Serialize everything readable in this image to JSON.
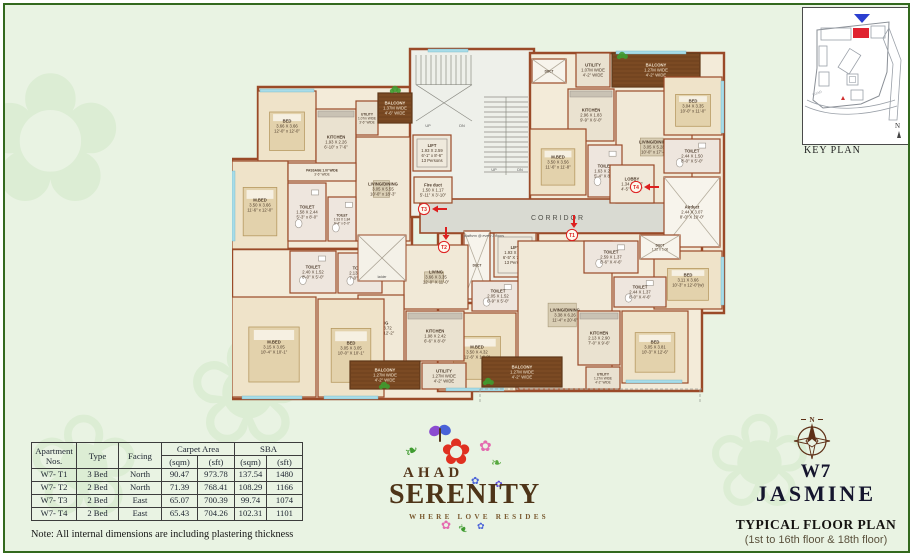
{
  "keyplan": {
    "label": "KEY PLAN",
    "road_label": "ROAD",
    "north_label": "N",
    "highlight_color": "#e02330",
    "marker_color": "#2b3fd0"
  },
  "logo": {
    "ahad": "AHAD",
    "serenity": "SERENITY",
    "tagline": "WHERE LOVE RESIDES"
  },
  "titles": {
    "tower": "W7",
    "name": "JASMINE",
    "plan_title": "TYPICAL FLOOR PLAN",
    "plan_subtitle": "(1st to 16th floor & 18th floor)",
    "compass_n": "N"
  },
  "note": "Note: All internal dimensions are including plastering thickness",
  "table": {
    "headers": {
      "apartment": "Apartment Nos.",
      "type": "Type",
      "facing": "Facing",
      "carpet": "Carpet Area",
      "sba": "SBA",
      "sqm": "(sqm)",
      "sft": "(sft)"
    },
    "rows": [
      [
        "W7- T1",
        "3 Bed",
        "North",
        "90.47",
        "973.78",
        "137.54",
        "1480"
      ],
      [
        "W7- T2",
        "2 Bed",
        "North",
        "71.39",
        "768.41",
        "108.29",
        "1166"
      ],
      [
        "W7- T3",
        "2 Bed",
        "East",
        "65.07",
        "700.39",
        "99.74",
        "1074"
      ],
      [
        "W7- T4",
        "2 Bed",
        "East",
        "65.43",
        "704.26",
        "102.31",
        "1101"
      ]
    ]
  },
  "plan": {
    "wall_color": "#9a4a28",
    "unit_fill": "#f3ebd9",
    "core_fill": "#eef0ea",
    "corridor_fill": "#d9dad2",
    "balcony_fill": "#7b4a23",
    "accent_red": "#dd1f1f",
    "window_color": "#a8dce8",
    "label_color": "#4c3a2a",
    "blocks": [
      {
        "n": "unit-t3",
        "p": "M26,42 L180,42 L180,204 L0,204 L0,114 L26,114 Z",
        "f": "unit"
      },
      {
        "n": "core-north",
        "p": "M178,4 L302,4 L302,172 L178,172 Z",
        "f": "core"
      },
      {
        "n": "unit-t4",
        "p": "M298,8 L492,8 L492,268 L418,268 L418,192 L298,192 Z",
        "f": "unit"
      },
      {
        "n": "unit-t2",
        "p": "M0,204 L240,204 L240,354 L0,354 Z",
        "f": "unit"
      },
      {
        "n": "unit-t1",
        "p": "M206,188 L470,188 L470,346 L206,346 Z",
        "f": "unit"
      },
      {
        "n": "core-south",
        "p": "M230,184 L306,184 L306,258 L230,258 Z",
        "f": "core"
      }
    ],
    "corridor": {
      "x": 188,
      "y": 154,
      "w": 248,
      "h": 34,
      "label": "CORRIDOR"
    },
    "rooms": [
      {
        "n": "bed-t3",
        "t": "bed",
        "x": 26,
        "y": 46,
        "w": 58,
        "h": 70,
        "l": [
          "BED",
          "3.66 X 3.66",
          "12'-0\" x 12'-0\""
        ]
      },
      {
        "n": "mbed-t3",
        "t": "bed",
        "x": 0,
        "y": 116,
        "w": 56,
        "h": 88,
        "l": [
          "M.BED",
          "3.50 X 3.66",
          "11'-6\" x 12'-0\""
        ]
      },
      {
        "n": "kitchen-t3",
        "t": "kitchen",
        "x": 84,
        "y": 64,
        "w": 40,
        "h": 66,
        "l": [
          "KITCHEN",
          "1.93 X 2.26",
          "6'-10\" x 7'-6\""
        ]
      },
      {
        "n": "utility-t3",
        "t": "utility",
        "x": 124,
        "y": 56,
        "w": 22,
        "h": 34,
        "l": [
          "UTILITY",
          "1.07m WIDE",
          "3'-6\" WIDE"
        ]
      },
      {
        "n": "balcony-t3",
        "t": "balcony",
        "x": 146,
        "y": 48,
        "w": 34,
        "h": 30,
        "l": [
          "BALCONY",
          "1.37M WIDE",
          "4'-6\" WIDE"
        ]
      },
      {
        "n": "living-dining-t3",
        "t": "living",
        "x": 124,
        "y": 92,
        "w": 54,
        "h": 104,
        "l": [
          "LIVING/DINING",
          "3.05 X 5.55",
          "10'-0\" x 18'-3\""
        ]
      },
      {
        "n": "passage-t3",
        "t": "lobby",
        "x": 56,
        "y": 118,
        "w": 68,
        "h": 18,
        "l": [
          "PASSAGE 1.07 WIDE",
          "3'-6\" WIDE"
        ]
      },
      {
        "n": "toilet-t3-a",
        "t": "toilet",
        "x": 56,
        "y": 138,
        "w": 38,
        "h": 58,
        "l": [
          "TOILET",
          "1.58 X 2.44",
          "5'-3\" x 8'-0\""
        ]
      },
      {
        "n": "toilet-t3-b",
        "t": "toilet",
        "x": 96,
        "y": 152,
        "w": 28,
        "h": 44,
        "l": [
          "TOILET",
          "1.93 X 1.84",
          "6'-4\" x 6'-0\""
        ]
      },
      {
        "n": "lift-1",
        "t": "lift",
        "x": 181,
        "y": 90,
        "w": 38,
        "h": 36,
        "l": [
          "LIFT",
          "1.93 X 2.59",
          "6'-1\" x 8'-6\"",
          "13 Persons"
        ]
      },
      {
        "n": "fire-duct",
        "t": "lobby",
        "x": 182,
        "y": 132,
        "w": 38,
        "h": 26,
        "l": [
          "Fire duct",
          "1.50 X 1.17",
          "5'-11\" X 3'-10\""
        ]
      },
      {
        "n": "duct-t4-top",
        "t": "duct",
        "x": 300,
        "y": 14,
        "w": 34,
        "h": 24,
        "l": [
          "DUCT"
        ]
      },
      {
        "n": "utility-t4",
        "t": "utility",
        "x": 344,
        "y": 8,
        "w": 34,
        "h": 34,
        "l": [
          "UTILITY",
          "1.07M WIDE",
          "4'-2\" WIDE"
        ]
      },
      {
        "n": "balcony-t4",
        "t": "balcony",
        "x": 380,
        "y": 8,
        "w": 88,
        "h": 34,
        "l": [
          "BALCONY",
          "1.27M WIDE",
          "4'-2\" WIDE"
        ]
      },
      {
        "n": "kitchen-t4",
        "t": "kitchen",
        "x": 336,
        "y": 44,
        "w": 46,
        "h": 52,
        "l": [
          "KITCHEN",
          "2.96 X 1.83",
          "9'-9\" X 6'-0\""
        ]
      },
      {
        "n": "living-dining-t4",
        "t": "living",
        "x": 384,
        "y": 46,
        "w": 76,
        "h": 112,
        "l": [
          "LIVING/DINING",
          "3.05 X 5.28",
          "10'-0\" x 17'-4\""
        ]
      },
      {
        "n": "bed-t4-a",
        "t": "bed",
        "x": 432,
        "y": 32,
        "w": 58,
        "h": 58,
        "l": [
          "BED",
          "3.04 X 3.35",
          "10'-0\" x 11'-0\""
        ]
      },
      {
        "n": "mbed-t4",
        "t": "bed",
        "x": 298,
        "y": 84,
        "w": 56,
        "h": 66,
        "l": [
          "M.BED",
          "3.50 X 3.56",
          "11'-6\" x 11'-8\""
        ]
      },
      {
        "n": "toilet-t4-a",
        "t": "toilet",
        "x": 356,
        "y": 100,
        "w": 34,
        "h": 52,
        "l": [
          "TOILET",
          "1.63 X 2.44",
          "5'-4\" X 8'-0\""
        ]
      },
      {
        "n": "toilet-t4-b",
        "t": "toilet",
        "x": 432,
        "y": 94,
        "w": 56,
        "h": 34,
        "l": [
          "TOILET",
          "2.44 X 1.50",
          "8'-0\" X 5'-0\""
        ]
      },
      {
        "n": "airduct-t4",
        "t": "duct",
        "x": 432,
        "y": 132,
        "w": 56,
        "h": 70,
        "l": [
          "Airduct",
          "2.44 X 3.07",
          "8'-0\" X 10'-0\""
        ]
      },
      {
        "n": "lobby-t4",
        "t": "lobby",
        "x": 378,
        "y": 120,
        "w": 44,
        "h": 38,
        "l": [
          "LOBBY",
          "1.34 X 1.57",
          "4'-5\" X 5'-2\""
        ]
      },
      {
        "n": "bed-t4-b",
        "t": "bed",
        "x": 422,
        "y": 206,
        "w": 68,
        "h": 58,
        "l": [
          "BED",
          "3.11 X 3.66",
          "10'-3\" x 12'-0\"(w)"
        ]
      },
      {
        "n": "duct-south",
        "t": "duct",
        "x": 232,
        "y": 186,
        "w": 26,
        "h": 68,
        "l": [
          "DUCT"
        ]
      },
      {
        "n": "lift-2",
        "t": "lift",
        "x": 262,
        "y": 188,
        "w": 42,
        "h": 44,
        "l": [
          "LIFT",
          "1.93 X 2.42",
          "6'-5\" X 7'-10\"",
          "13 Persons"
        ]
      },
      {
        "n": "toilet-core",
        "t": "toilet",
        "x": 240,
        "y": 236,
        "w": 52,
        "h": 30,
        "l": [
          "TOILET",
          "2.05 X 1.52",
          "6'-9\" X 5'-0\""
        ]
      },
      {
        "n": "mbed-t1",
        "t": "bed",
        "x": 206,
        "y": 268,
        "w": 78,
        "h": 78,
        "l": [
          "M.BED",
          "3.50 X 4.32",
          "11'-6\" X 14'-2\""
        ]
      },
      {
        "n": "living-dining-t1",
        "t": "living",
        "x": 286,
        "y": 196,
        "w": 94,
        "h": 148,
        "l": [
          "LIVING/DINING",
          "3.38 X 6.26",
          "11'-4\" x 20'-6\""
        ]
      },
      {
        "n": "toilet-t1-a",
        "t": "toilet",
        "x": 352,
        "y": 196,
        "w": 54,
        "h": 32,
        "l": [
          "TOILET",
          "2.59 X 1.37",
          "8'-6\" X 4'-6\""
        ]
      },
      {
        "n": "toilet-t1-b",
        "t": "toilet",
        "x": 382,
        "y": 232,
        "w": 52,
        "h": 30,
        "l": [
          "TOILET",
          "2.44 X 1.37",
          "8'-0\" X 4'-6\""
        ]
      },
      {
        "n": "duct-t1",
        "t": "duct",
        "x": 408,
        "y": 190,
        "w": 40,
        "h": 24,
        "l": [
          "DUCT",
          "1.22 X 1.06"
        ]
      },
      {
        "n": "kitchen-t1",
        "t": "kitchen",
        "x": 346,
        "y": 266,
        "w": 42,
        "h": 54,
        "l": [
          "KITCHEN",
          "2.13 X 2.90",
          "7'-0\" X 9'-6\""
        ]
      },
      {
        "n": "bed-t1",
        "t": "bed",
        "x": 390,
        "y": 266,
        "w": 66,
        "h": 72,
        "l": [
          "BED",
          "3.05 X 3.81",
          "10'-3\" X 12'-6\""
        ]
      },
      {
        "n": "balcony-t1",
        "t": "balcony",
        "x": 250,
        "y": 312,
        "w": 80,
        "h": 30,
        "l": [
          "BALCONY",
          "1.27M WIDE",
          "4'-2\" WIDE"
        ]
      },
      {
        "n": "utility-t1",
        "t": "utility",
        "x": 354,
        "y": 322,
        "w": 34,
        "h": 22,
        "l": [
          "UTILITY",
          "1.27m WIDE",
          "4'-2\" WIDE"
        ]
      },
      {
        "n": "toilet-t2-a",
        "t": "toilet",
        "x": 58,
        "y": 206,
        "w": 46,
        "h": 42,
        "l": [
          "TOILET",
          "2.40 X 1.52",
          "8'-0\" X 5'-0\""
        ]
      },
      {
        "n": "toilet-t2-b",
        "t": "toilet",
        "x": 106,
        "y": 208,
        "w": 44,
        "h": 40,
        "l": [
          "TOILET",
          "2.13 X 1.84",
          "7'-0\" X 6'-0\""
        ]
      },
      {
        "n": "living-t2",
        "t": "living",
        "x": 172,
        "y": 200,
        "w": 64,
        "h": 64,
        "l": [
          "LIVING",
          "3.66 X 3.35",
          "12'-0\" X 11'-0\""
        ]
      },
      {
        "n": "dining-t2",
        "t": "living",
        "x": 126,
        "y": 250,
        "w": 46,
        "h": 66,
        "l": [
          "DINING",
          "3.05 X 3.72",
          "10'-0\" X 12'-2\""
        ]
      },
      {
        "n": "kitchen-t2",
        "t": "kitchen",
        "x": 174,
        "y": 266,
        "w": 58,
        "h": 50,
        "l": [
          "KITCHEN",
          "1.98 X 2.42",
          "6'-6\" X 8'-0\""
        ]
      },
      {
        "n": "mbed-t2",
        "t": "bed",
        "x": 0,
        "y": 252,
        "w": 84,
        "h": 100,
        "l": [
          "M.BED",
          "3.15 X 3.05",
          "10'-4\" X 10'-1\""
        ]
      },
      {
        "n": "bed-t2",
        "t": "bed",
        "x": 86,
        "y": 254,
        "w": 66,
        "h": 98,
        "l": [
          "BED",
          "3.05 X 3.05",
          "10'-0\" X 10'-1\""
        ]
      },
      {
        "n": "balcony-t2",
        "t": "balcony",
        "x": 118,
        "y": 316,
        "w": 70,
        "h": 28,
        "l": [
          "BALCONY",
          "1.27M WIDE",
          "4'-2\" WIDE"
        ]
      },
      {
        "n": "utility-t2",
        "t": "utility",
        "x": 190,
        "y": 318,
        "w": 44,
        "h": 26,
        "l": [
          "UTILITY",
          "1.27M WIDE",
          "4'-2\" WIDE"
        ]
      }
    ],
    "shaft": {
      "x": 126,
      "y": 190,
      "w": 48,
      "h": 46,
      "label": "ladder"
    },
    "stairs": [
      {
        "n": "stair-north",
        "x": 184,
        "y": 10,
        "w": 56,
        "h": 66,
        "dir": "v"
      },
      {
        "n": "stair-mid",
        "x": 252,
        "y": 52,
        "w": 44,
        "h": 78,
        "dir": "h"
      }
    ],
    "texts": [
      {
        "t": "platform @ every 3 floors",
        "x": 252,
        "y": 192,
        "fs": 3.6,
        "c": "#4f4f4f",
        "n": "platform-note"
      },
      {
        "t": "UP",
        "x": 196,
        "y": 82,
        "fs": 3.8,
        "c": "#555",
        "n": "up-label-1"
      },
      {
        "t": "DN",
        "x": 230,
        "y": 82,
        "fs": 3.8,
        "c": "#555",
        "n": "dn-label-1"
      },
      {
        "t": "UP",
        "x": 262,
        "y": 126,
        "fs": 3.8,
        "c": "#555",
        "n": "up-label-2"
      },
      {
        "t": "DN",
        "x": 288,
        "y": 126,
        "fs": 3.8,
        "c": "#555",
        "n": "dn-label-2"
      }
    ],
    "windows": [
      {
        "x": 28,
        "y": 44,
        "w": 54,
        "h": 3
      },
      {
        "x": 0,
        "y": 126,
        "w": 3,
        "h": 70
      },
      {
        "x": 489,
        "y": 36,
        "w": 3,
        "h": 52
      },
      {
        "x": 489,
        "y": 212,
        "w": 3,
        "h": 48
      },
      {
        "x": 10,
        "y": 351,
        "w": 60,
        "h": 3
      },
      {
        "x": 92,
        "y": 351,
        "w": 54,
        "h": 3
      },
      {
        "x": 214,
        "y": 343,
        "w": 58,
        "h": 3
      },
      {
        "x": 394,
        "y": 335,
        "w": 56,
        "h": 3
      },
      {
        "x": 196,
        "y": 4,
        "w": 40,
        "h": 3
      },
      {
        "x": 384,
        "y": 6,
        "w": 70,
        "h": 3
      }
    ],
    "plants": [
      {
        "x": 163,
        "y": 44
      },
      {
        "x": 390,
        "y": 10
      },
      {
        "x": 256,
        "y": 336
      },
      {
        "x": 152,
        "y": 340
      }
    ],
    "markers": [
      {
        "id": "T1",
        "x": 340,
        "y": 190,
        "dir": "down"
      },
      {
        "id": "T2",
        "x": 212,
        "y": 202,
        "dir": "down"
      },
      {
        "id": "T3",
        "x": 192,
        "y": 164,
        "dir": "left"
      },
      {
        "id": "T4",
        "x": 404,
        "y": 142,
        "dir": "left"
      }
    ]
  }
}
